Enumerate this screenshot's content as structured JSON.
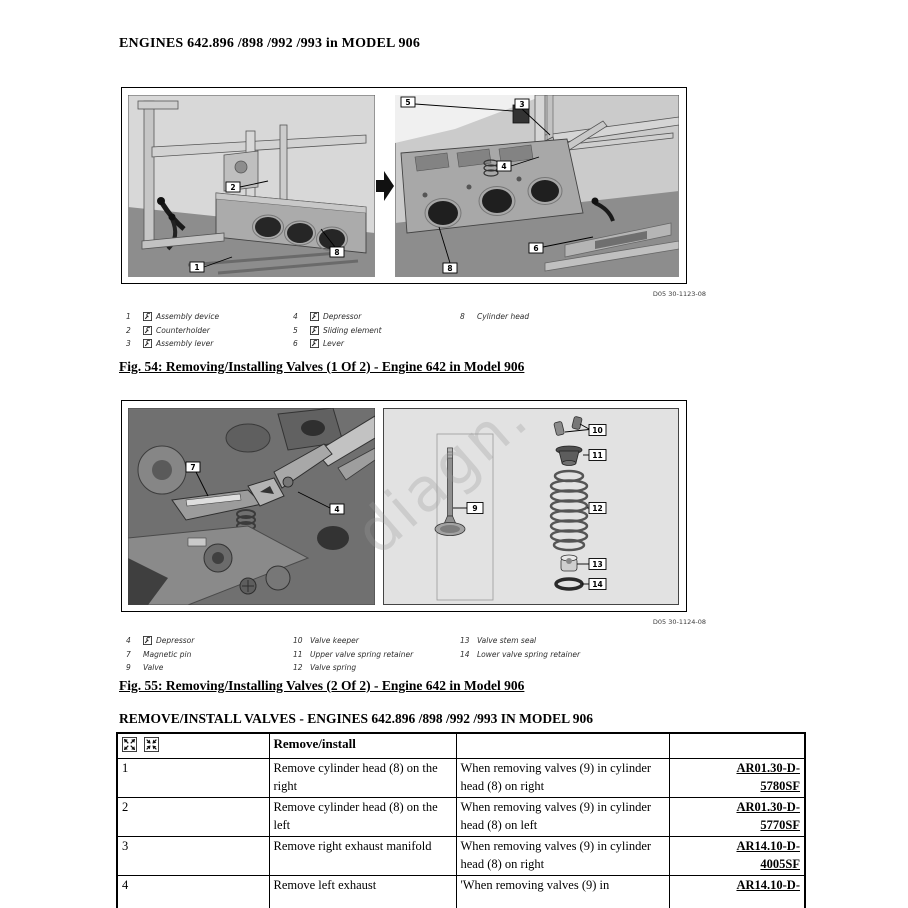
{
  "page_title": "ENGINES 642.896 /898 /992 /993 in MODEL 906",
  "figure1": {
    "ref_code": "D05 30-1123-08",
    "caption": "Fig. 54: Removing/Installing Valves (1 Of 2) - Engine 642 in Model 906",
    "callouts": {
      "n1": "1",
      "n2": "2",
      "n3": "3",
      "n4": "4",
      "n5": "5",
      "n6": "6",
      "n8": "8"
    },
    "legend": {
      "col1": [
        {
          "n": "1",
          "label": "Assembly device"
        },
        {
          "n": "2",
          "label": "Counterholder"
        },
        {
          "n": "3",
          "label": "Assembly lever"
        }
      ],
      "col2": [
        {
          "n": "4",
          "label": "Depressor"
        },
        {
          "n": "5",
          "label": "Sliding element"
        },
        {
          "n": "6",
          "label": "Lever"
        }
      ],
      "col3": [
        {
          "n": "8",
          "label": "Cylinder head"
        }
      ]
    }
  },
  "figure2": {
    "ref_code": "D05 30-1124-08",
    "caption": "Fig. 55: Removing/Installing Valves (2 Of 2) - Engine 642 in Model 906",
    "callouts": {
      "n4": "4",
      "n7": "7",
      "n9": "9",
      "n10": "10",
      "n11": "11",
      "n12": "12",
      "n13": "13",
      "n14": "14"
    },
    "legend": {
      "col1": [
        {
          "n": "4",
          "label": "Depressor"
        },
        {
          "n": "7",
          "label": "Magnetic pin"
        },
        {
          "n": "9",
          "label": "Valve"
        }
      ],
      "col2": [
        {
          "n": "10",
          "label": "Valve keeper"
        },
        {
          "n": "11",
          "label": "Upper valve spring retainer"
        },
        {
          "n": "12",
          "label": "Valve spring"
        }
      ],
      "col3": [
        {
          "n": "13",
          "label": "Valve stem seal"
        },
        {
          "n": "14",
          "label": "Lower valve spring retainer"
        }
      ]
    }
  },
  "section_title": "REMOVE/INSTALL VALVES - ENGINES 642.896 /898 /992 /993 IN MODEL 906",
  "table": {
    "header": {
      "col2": "Remove/install"
    },
    "rows": [
      {
        "num": "1",
        "step": "Remove cylinder head (8) on the right",
        "note": "When removing valves (9) in cylinder head (8) on right",
        "link_lines": [
          "AR01.30-D-",
          "5780SF"
        ]
      },
      {
        "num": "2",
        "step": "Remove cylinder head (8) on the left",
        "note": "When removing valves (9) in cylinder head (8) on left",
        "link_lines": [
          "AR01.30-D-",
          "5770SF"
        ]
      },
      {
        "num": "3",
        "step": "Remove right exhaust manifold",
        "note": "When removing valves (9) in cylinder head (8) on right",
        "link_lines": [
          "AR14.10-D-",
          "4005SF"
        ]
      },
      {
        "num": "4",
        "step": "Remove left exhaust",
        "note": "'When removing valves (9) in",
        "link_lines": [
          "AR14.10-D-"
        ]
      }
    ]
  },
  "watermark": "diagn."
}
